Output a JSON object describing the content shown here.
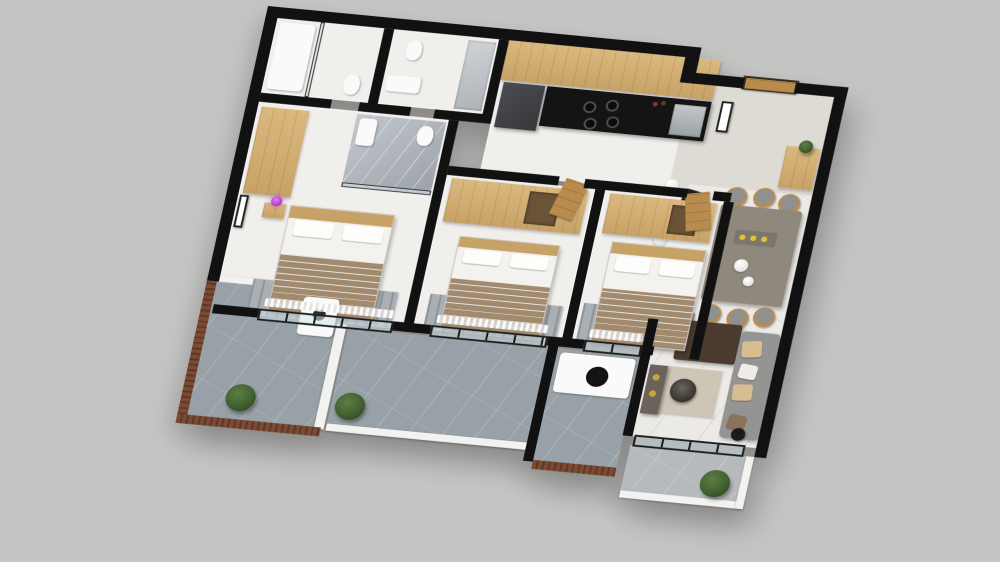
{
  "scene": {
    "type": "isometric-3d-floor-plan-render",
    "description": "Top-down isometric 3D render of a three-bedroom apartment with kitchen, dining area, living room and wrap-around balconies on a plain gray backdrop",
    "visible_text": "none"
  },
  "palette": {
    "bg": "#c5c6c4",
    "wall": "#111111",
    "floor": "#f1efec",
    "marble": "#eceae6",
    "entry_floor": "#dedbd4",
    "gray_marble": "#9ba1a8",
    "balcony": "#98a1a7",
    "balcony_light": "#b6babd",
    "louver": "#7b4a33",
    "louver_dark": "#5e3726",
    "wood": "#c7a267",
    "wood_light": "#dab97e",
    "wood_dark": "#b98c4e",
    "fridge": "#36383b",
    "counter": "#141414",
    "steel": "#9aa0a4",
    "table": "#8f887c",
    "sofa": "#949492",
    "pillow_tan": "#d7bd92",
    "blanket": "#a28a6e",
    "rug": "#a9afb3",
    "rug_beige": "#cdc5b6",
    "dark_table": "#4a3b2e",
    "console": "#6b635a",
    "gold": "#c9a53f",
    "plant": "#41602f",
    "plant_dark": "#2f4722",
    "lamp_purple": "#b441cc",
    "accent_yellow": "#e0c23c",
    "glass": "rgba(214,227,234,0.55)"
  },
  "rooms": [
    {
      "id": "master-bedroom",
      "name": "Master Bedroom"
    },
    {
      "id": "ensuite-bathroom",
      "name": "En-suite Bathroom"
    },
    {
      "id": "bathroom-a",
      "name": "Bathroom 1"
    },
    {
      "id": "bathroom-b",
      "name": "Bathroom 2"
    },
    {
      "id": "bedroom-2",
      "name": "Bedroom 2"
    },
    {
      "id": "bedroom-3",
      "name": "Bedroom 3"
    },
    {
      "id": "kitchen",
      "name": "Kitchen"
    },
    {
      "id": "hallway",
      "name": "Hallway"
    },
    {
      "id": "entry",
      "name": "Entry Hall"
    },
    {
      "id": "dining-area",
      "name": "Dining Area"
    },
    {
      "id": "living-room",
      "name": "Living Room"
    },
    {
      "id": "service-balcony",
      "name": "Service Balcony"
    },
    {
      "id": "main-balcony",
      "name": "Main Balcony"
    },
    {
      "id": "laundry-balcony",
      "name": "Laundry Balcony"
    },
    {
      "id": "living-balcony",
      "name": "Living Room Balcony"
    }
  ],
  "furniture": {
    "bed": "Double bed with brown blanket",
    "wardrobe": "Light wood wardrobe",
    "rug": "Gray bedroom rug",
    "fridge": "Refrigerator",
    "counter": "Black kitchen counter with cooktop",
    "oven": "Oven",
    "upper_cabinets": "Wood kitchen cabinets",
    "entry_door": "Wooden entry door",
    "interior_door": "Wooden interior door",
    "shoe_cabinet": "Shoe cabinet",
    "dining_table": "Dining table",
    "dining_chair": "Dining chair",
    "desk_chair": "Black chair",
    "pendant": "White globe pendant lamp",
    "sofa": "Gray sofa with tan cushions",
    "coffee_table": "Dark coffee table",
    "side_table": "Round side table",
    "tv_console": "TV console",
    "floor_lamp": "Black arc floor lamp",
    "picture": "Framed picture",
    "purple_lamp": "Purple table lamp",
    "toilet": "Toilet",
    "sink": "Sink",
    "bathtub": "Shower / tub",
    "mirror_wall": "Glass / mirror wall",
    "washer": "Washing machine",
    "laundry_sink": "Laundry sink counter",
    "plant": "Green shrub planter",
    "louver_screen": "Wood louver privacy screen",
    "glass_door": "Black-framed sliding glass door",
    "curtain": "Sheer curtain"
  },
  "counts": {
    "bedrooms": 3,
    "bathrooms": 3,
    "balconies": 4,
    "dining_chairs": 6,
    "plants": 3,
    "beds": 3
  }
}
